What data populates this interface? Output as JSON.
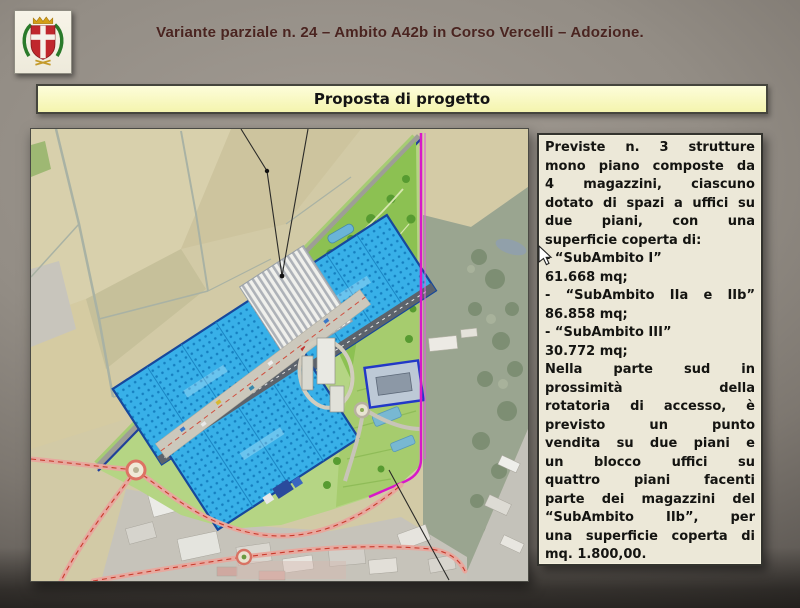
{
  "header": {
    "title": "Variante parziale n. 24 – Ambito A42b in Corso Vercelli – Adozione.",
    "logo_icon": "municipal-coat-of-arms"
  },
  "banner": {
    "title": "Proposta di progetto"
  },
  "map": {
    "kind": "aerial-site-plan"
  },
  "textbox": {
    "lines": [
      {
        "t": "Previste n. 3 strutture",
        "j": true
      },
      {
        "t": "mono piano composte da",
        "j": true
      },
      {
        "t": "4 magazzini, ciascuno",
        "j": true
      },
      {
        "t": "dotato di spazi a uffici su",
        "j": true
      },
      {
        "t": "due piani, con una",
        "j": true
      },
      {
        "t": "superficie coperta di:",
        "j": false
      },
      {
        "t": "- “SubAmbito I”",
        "j": false
      },
      {
        "t": "61.668 mq;",
        "j": false
      },
      {
        "t": "- “SubAmbito IIa e IIb”",
        "j": true
      },
      {
        "t": "86.858 mq;",
        "j": false
      },
      {
        "t": "- “SubAmbito III”",
        "j": false
      },
      {
        "t": "30.772 mq;",
        "j": false
      },
      {
        "t": "Nella parte sud in",
        "j": true
      },
      {
        "t": "prossimità della",
        "j": true
      },
      {
        "t": "rotatoria di accesso, è",
        "j": true
      },
      {
        "t": "previsto un punto",
        "j": true
      },
      {
        "t": "vendita su due piani e",
        "j": true
      },
      {
        "t": "un blocco uffici su",
        "j": true
      },
      {
        "t": "quattro piani facenti",
        "j": true
      },
      {
        "t": "parte dei magazzini del",
        "j": true
      },
      {
        "t": "“SubAmbito IIb”, per",
        "j": true
      },
      {
        "t": "una superficie coperta di",
        "j": true
      },
      {
        "t": "mq. 1.800,00.",
        "j": false
      }
    ]
  },
  "colors": {
    "title_text": "#4a2420",
    "banner_bg": "#f6f6b4",
    "textbox_bg": "#ece8d8",
    "warehouse_blue": "#38b0e8",
    "boundary_magenta": "#d818c8",
    "road_pink": "#e7a89e"
  }
}
